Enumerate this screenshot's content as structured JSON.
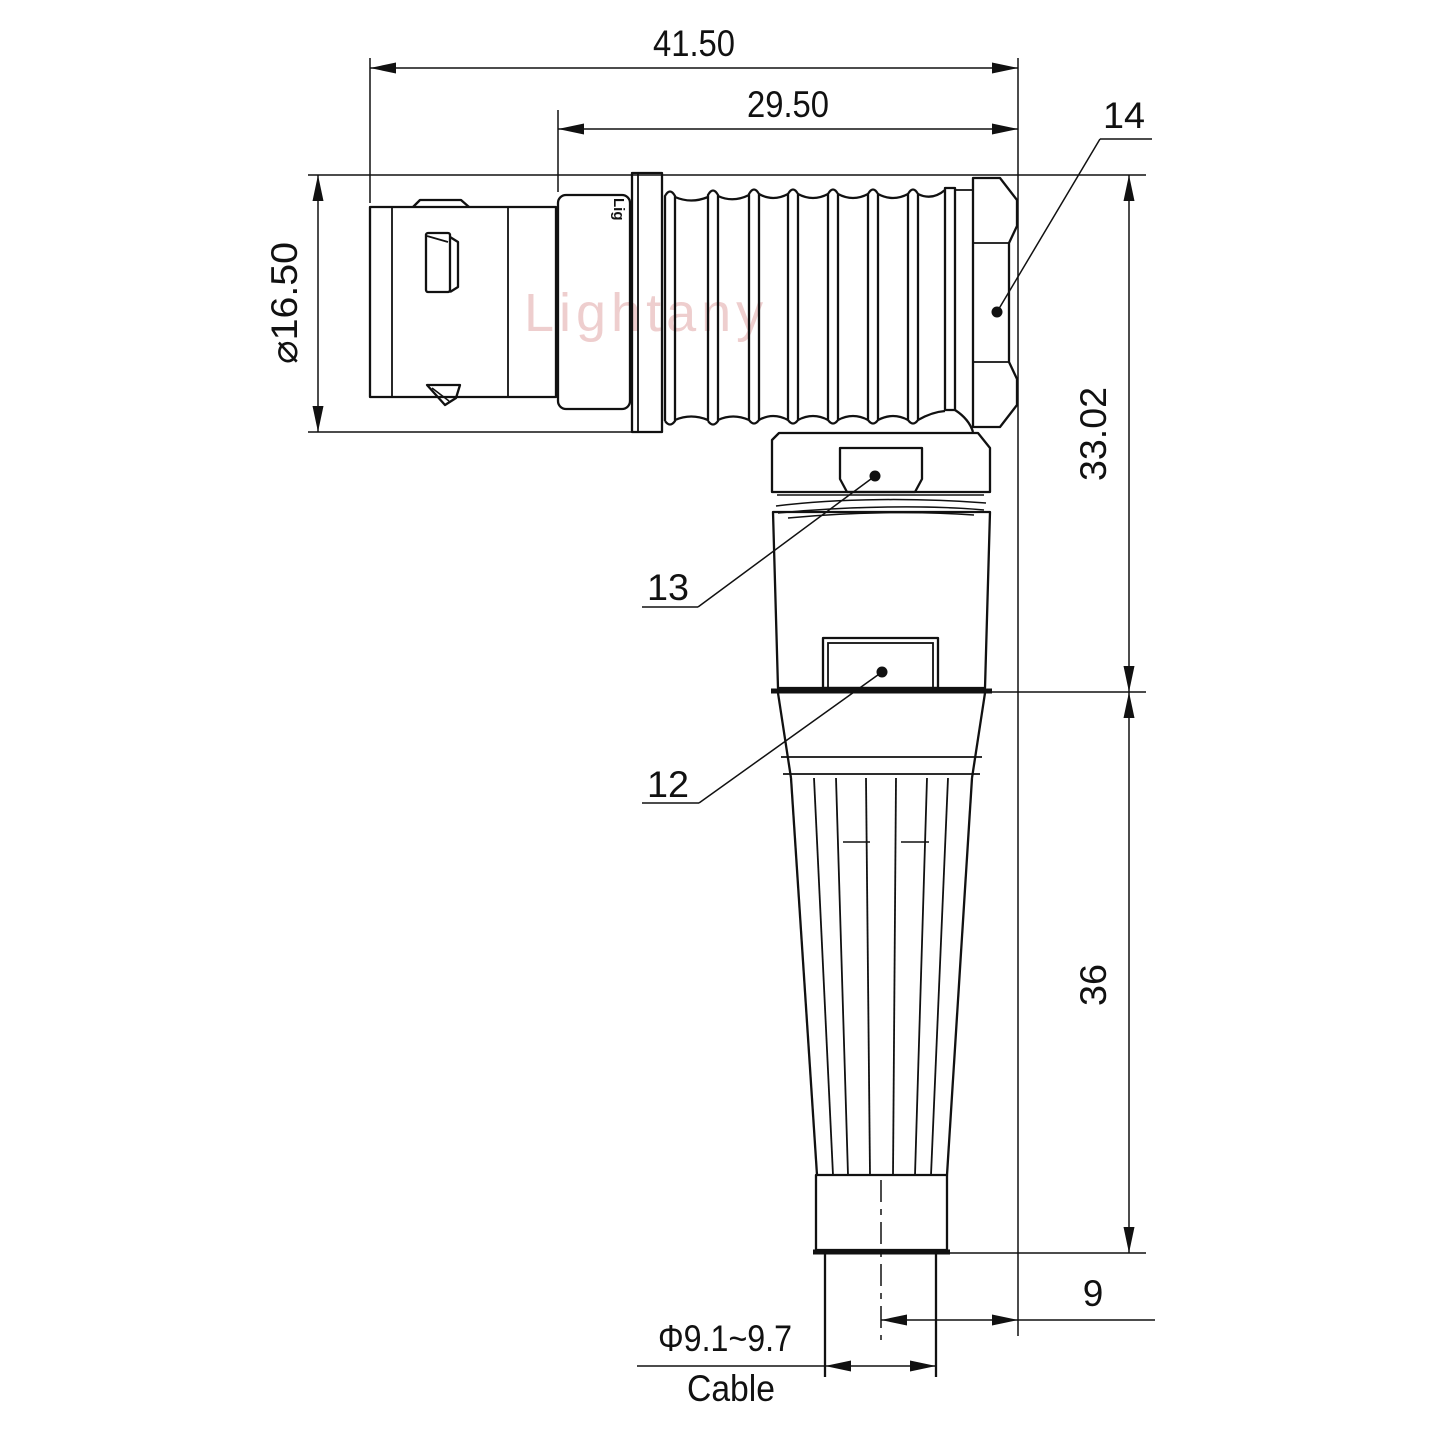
{
  "page": {
    "background": "#ffffff",
    "line_color": "#111111"
  },
  "watermark": {
    "text": "Lightany",
    "color": "#d98b8b"
  },
  "connector": {
    "sleeve_logo": "Lig"
  },
  "dims": {
    "overall_length": "41.50",
    "rear_length": "29.50",
    "shell_diameter": "⌀16.50",
    "elbow_height": "33.02",
    "boot_length": "36",
    "cable_axis_offset": "9",
    "cable_diameter": "Φ9.1~9.7",
    "cable_label": "Cable"
  },
  "callouts": {
    "nut": "14",
    "coupling": "13",
    "body": "12"
  }
}
